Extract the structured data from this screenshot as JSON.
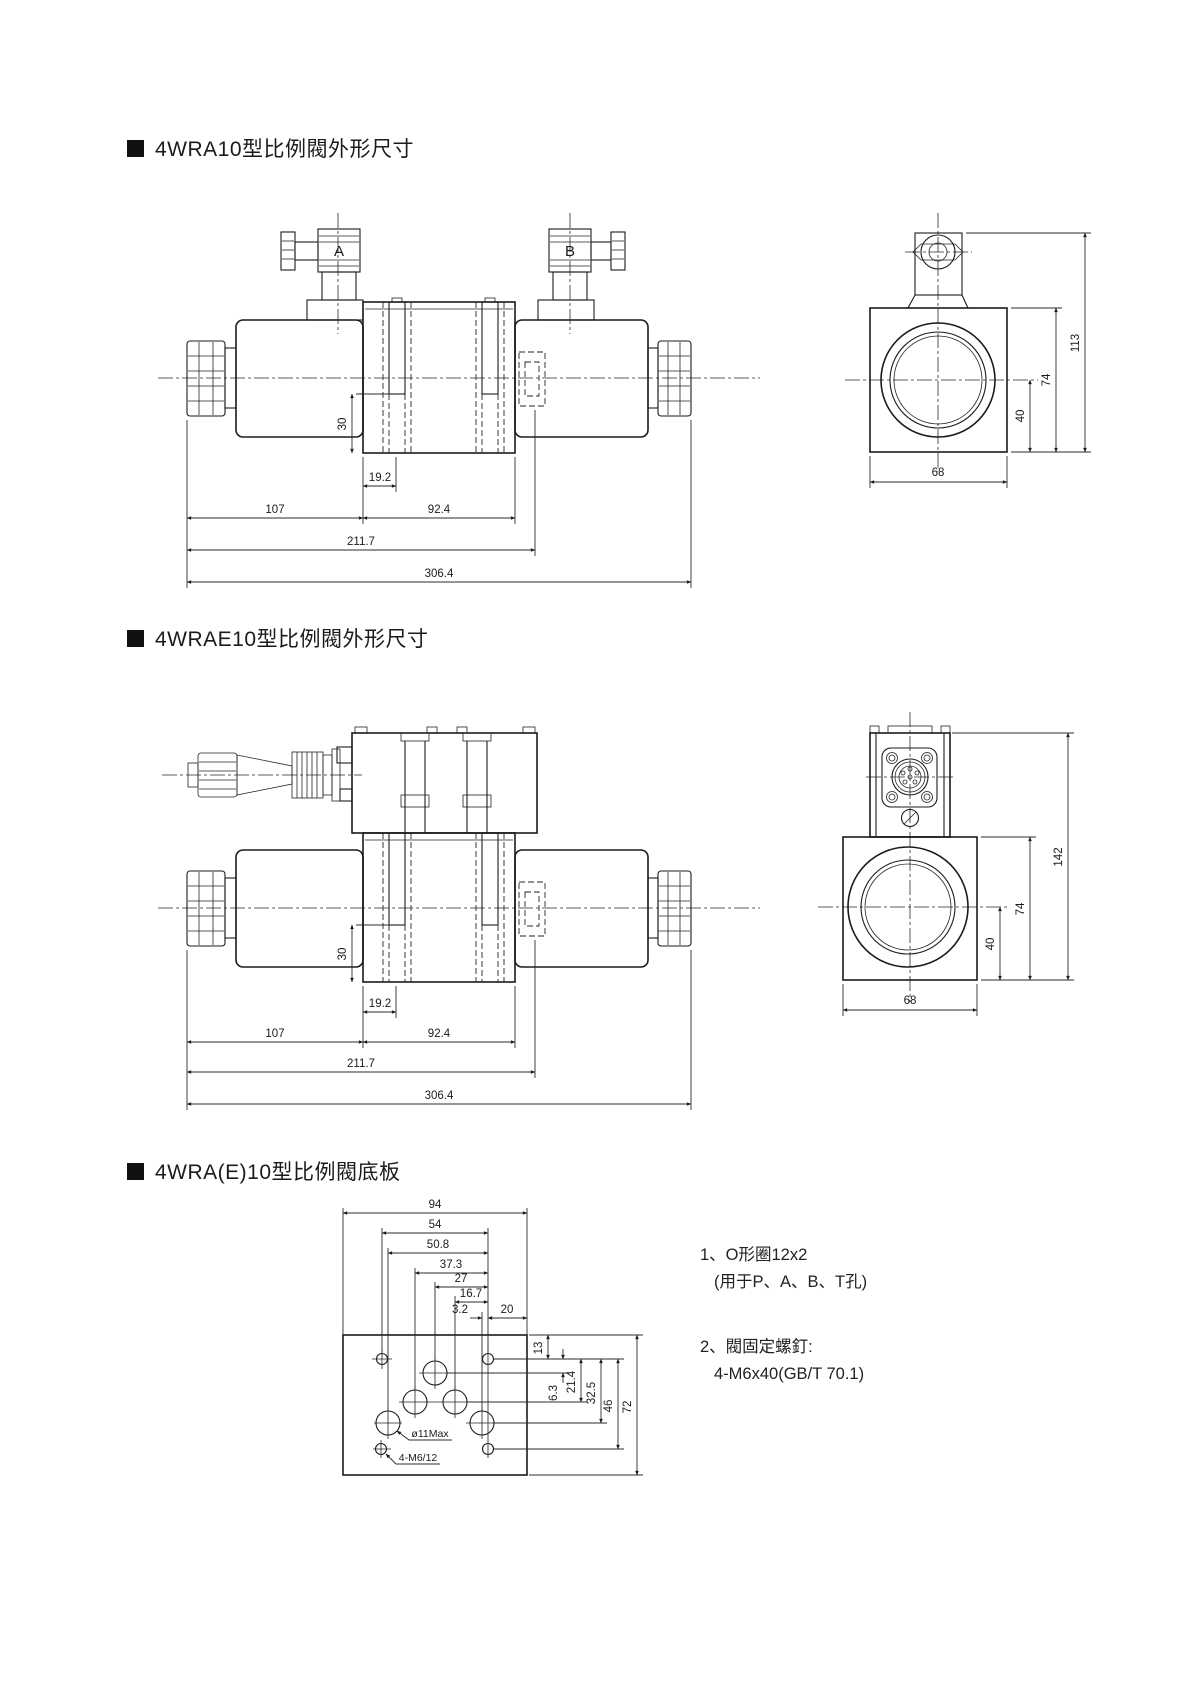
{
  "page": {
    "background": "#ffffff",
    "line_color": "#1b1b1b"
  },
  "sections": {
    "s1": {
      "title": "4WRA10型比例閥外形尺寸"
    },
    "s2": {
      "title": "4WRAE10型比例閥外形尺寸"
    },
    "s3": {
      "title": "4WRA(E)10型比例閥底板"
    }
  },
  "valve1": {
    "front": {
      "dim_30": "30",
      "dim_19_2": "19.2",
      "dim_107": "107",
      "dim_92_4": "92.4",
      "dim_211_7": "211.7",
      "dim_306_4": "306.4",
      "label_a": "A",
      "label_b": "B"
    },
    "side": {
      "dim_68": "68",
      "dim_40": "40",
      "dim_74": "74",
      "dim_113": "113"
    }
  },
  "valve2": {
    "front": {
      "dim_30": "30",
      "dim_19_2": "19.2",
      "dim_107": "107",
      "dim_92_4": "92.4",
      "dim_211_7": "211.7",
      "dim_306_4": "306.4"
    },
    "side": {
      "dim_68": "68",
      "dim_40": "40",
      "dim_74": "74",
      "dim_142": "142"
    }
  },
  "plate": {
    "dim_94": "94",
    "dim_54": "54",
    "dim_50_8": "50.8",
    "dim_37_3": "37.3",
    "dim_27": "27",
    "dim_16_7": "16.7",
    "dim_3_2": "3.2",
    "dim_20": "20",
    "dim_13": "13",
    "dim_6_3": "6.3",
    "dim_21_4": "21.4",
    "dim_32_5": "32.5",
    "dim_46": "46",
    "dim_72": "72",
    "label_hole": "ø11Max",
    "label_screw": "4-M6/12"
  },
  "notes": {
    "n1_line1": "1、O形圈12x2",
    "n1_line2": "(用于P、A、B、T孔)",
    "n2_line1": "2、閥固定螺釘:",
    "n2_line2": "4-M6x40(GB/T 70.1)"
  }
}
